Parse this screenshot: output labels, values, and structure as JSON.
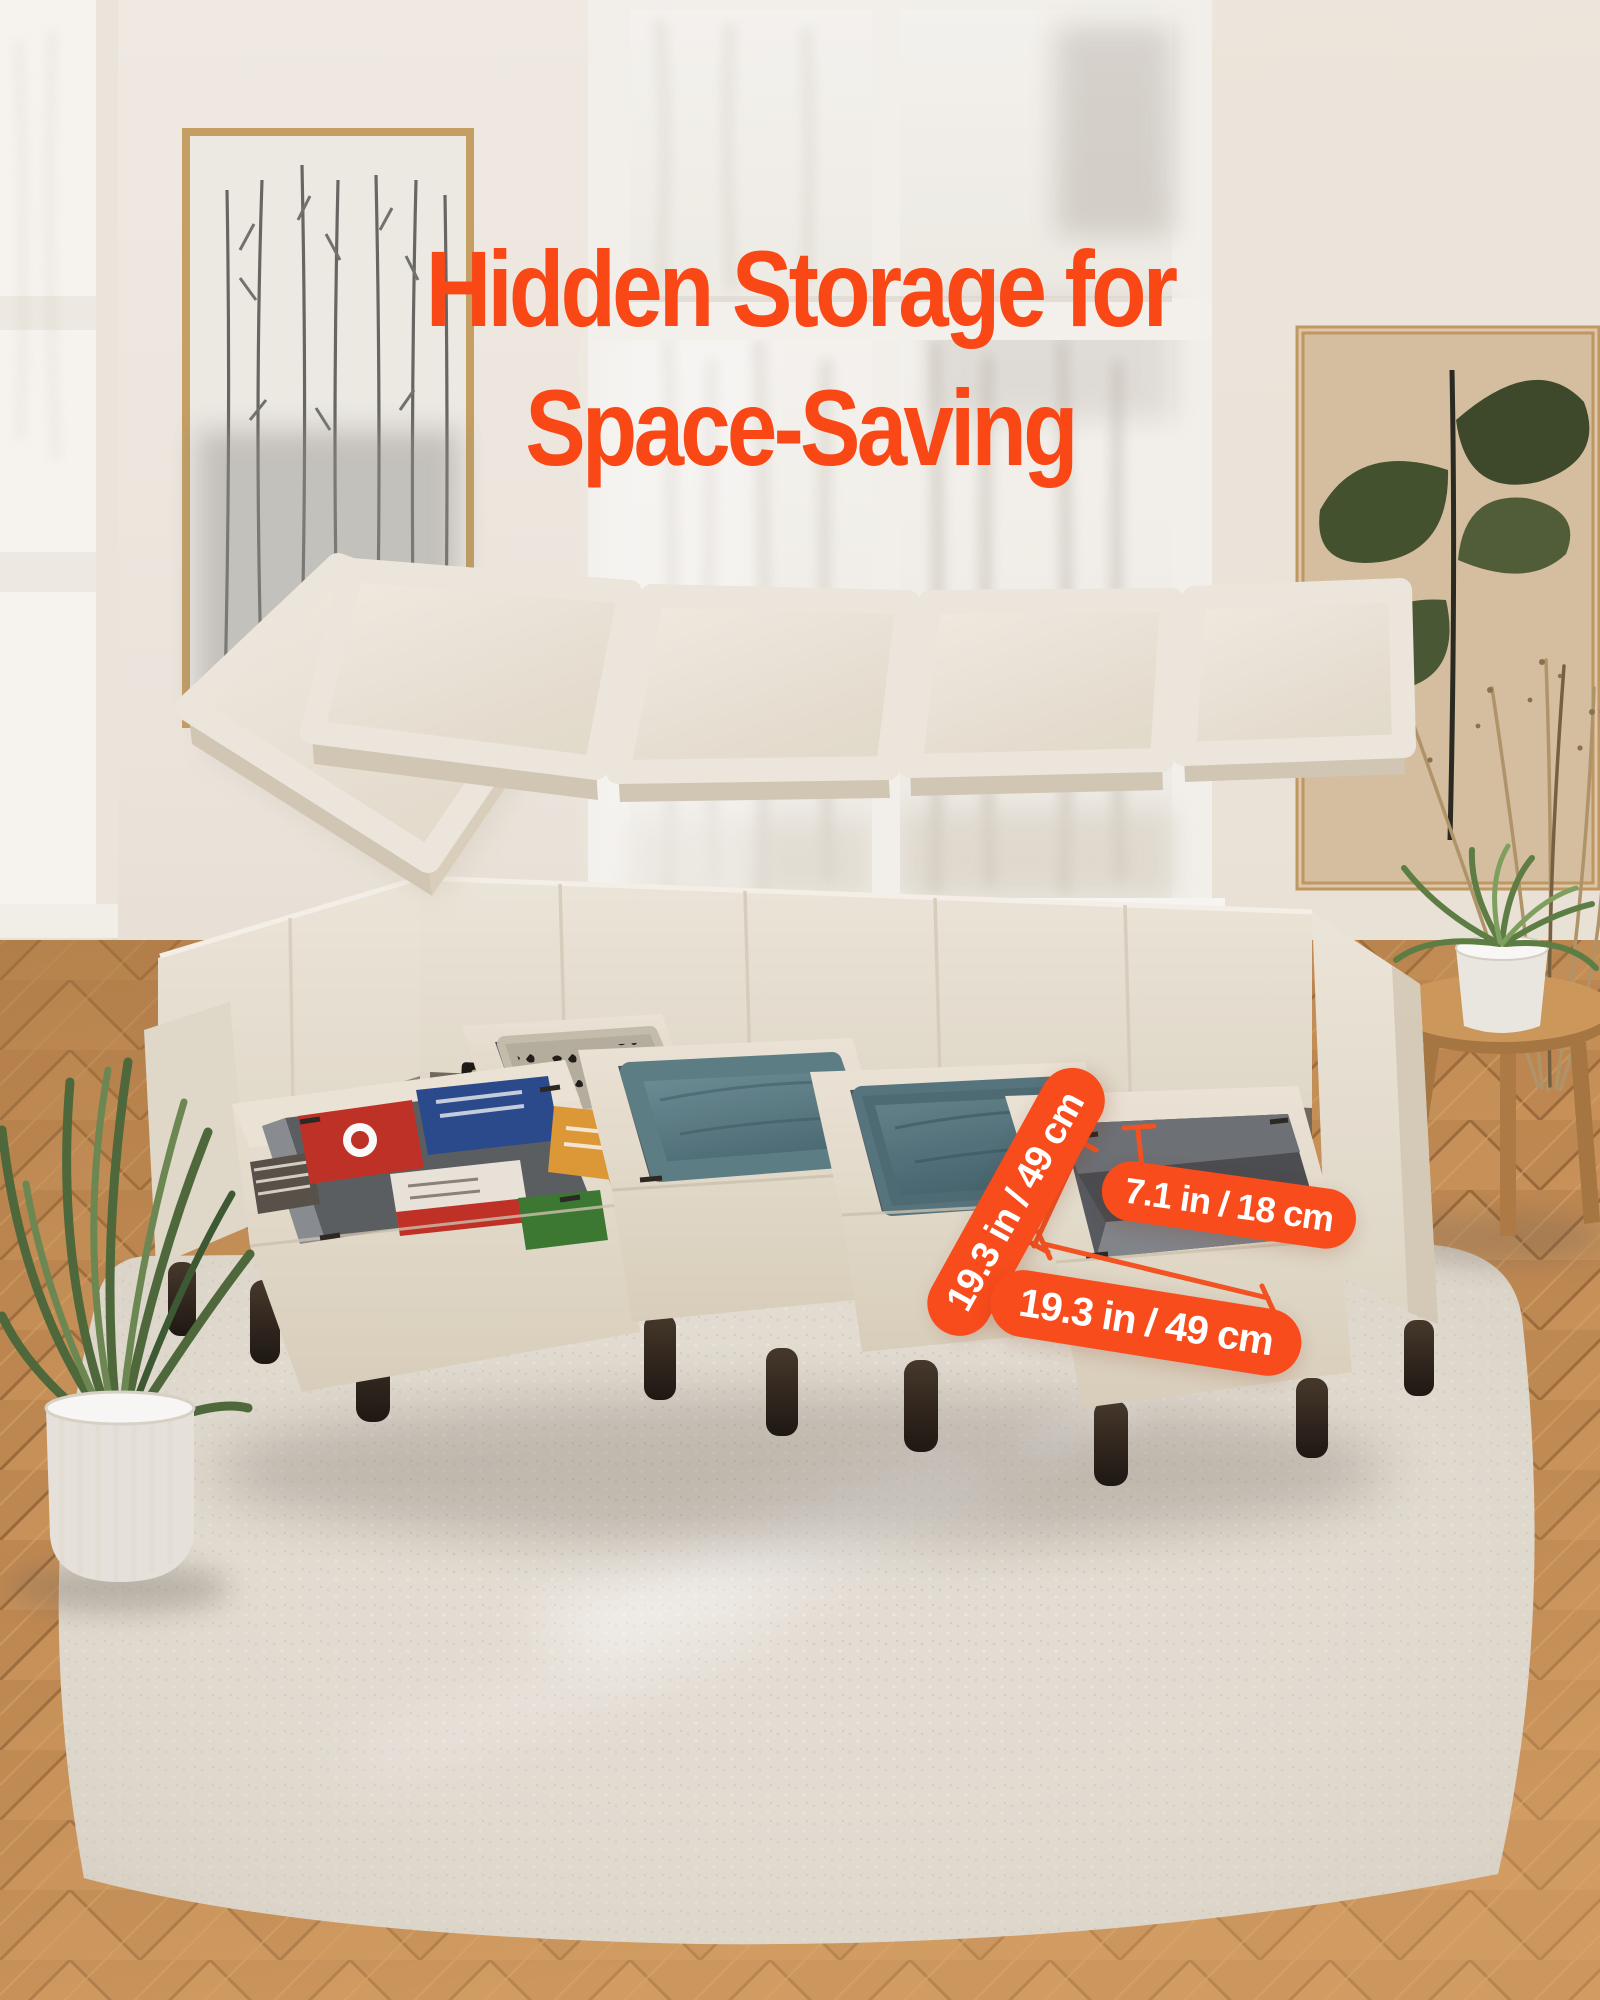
{
  "title": {
    "line1": "Hidden Storage for",
    "line2": "Space-Saving"
  },
  "dimension_labels": {
    "storage_side": "19.3 in / 49 cm",
    "storage_height": "7.1 in / 18 cm",
    "storage_front": "19.3 in / 49 cm"
  },
  "palette": {
    "title_orange": "#f94716",
    "badge_orange": "#f84c1d",
    "badge_text": "#ffffff",
    "measure_line_orange": "#f85322",
    "sofa_cream": "#ece5d7",
    "pillow_teal": "#5d7f88",
    "storage_interior_gray": "#55595d",
    "rug_ivory": "#e8e2d8",
    "wood_floor": "#c18a52"
  }
}
